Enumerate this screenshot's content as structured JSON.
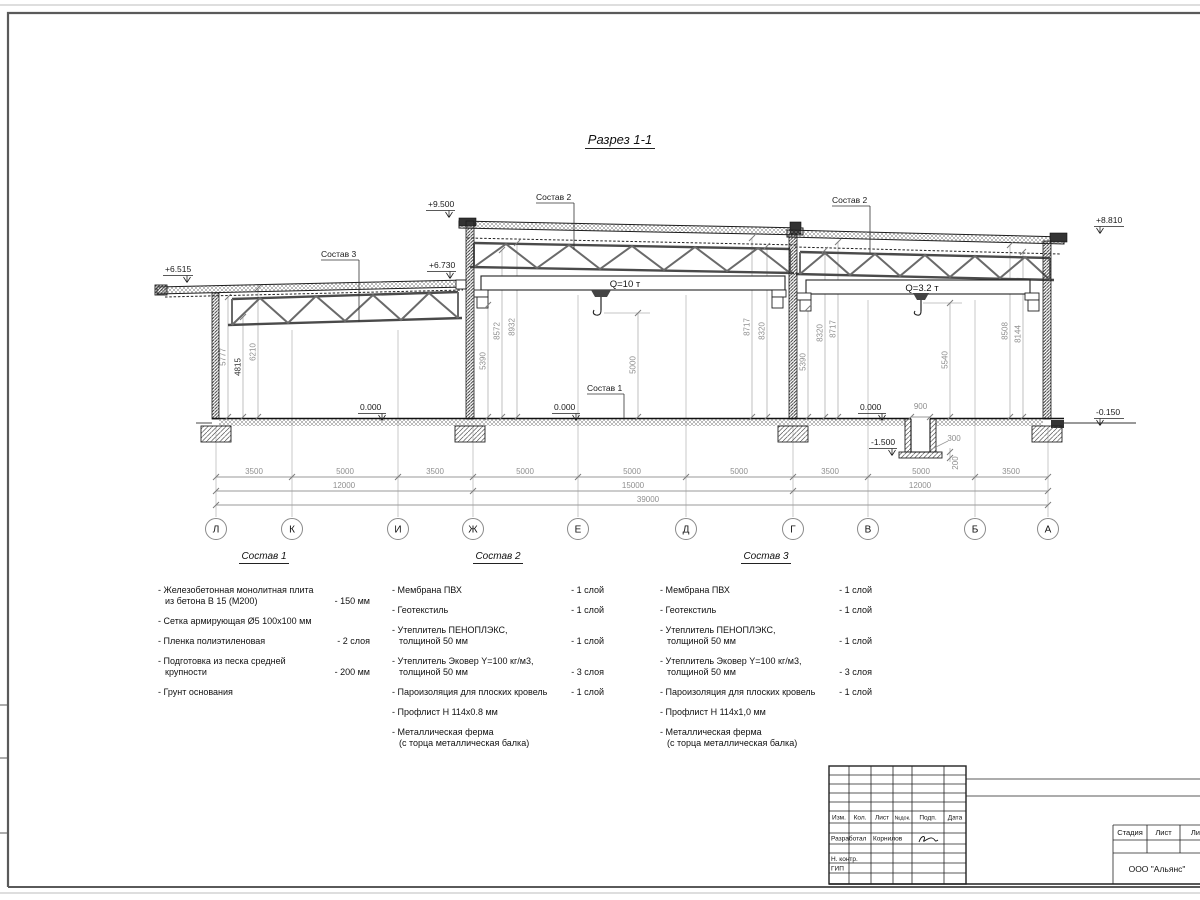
{
  "page": {
    "sheet_title": "Разрез 1-1"
  },
  "drawing": {
    "elevations": {
      "left_eave": "+6.515",
      "low_right": "+6.730",
      "mid_top": "+9.500",
      "right_top": "+8.810",
      "floor_left": "0.000",
      "floor_mid": "0.000",
      "floor_right": "0.000",
      "pit_bottom": "-1.500",
      "ground_right": "-0.150"
    },
    "callouts": {
      "sostav1": "Состав 1",
      "sostav2_mid": "Состав 2",
      "sostav2_right": "Состав 2",
      "sostav3": "Состав 3"
    },
    "cranes": {
      "mid": "Q=10 т",
      "right": "Q=3.2 т"
    },
    "vdims": {
      "l1": "5777",
      "l2": "4815",
      "l3": "6210",
      "m1": "5390",
      "m2": "8572",
      "m3": "8932",
      "m4": "5000",
      "m5": "8717",
      "m6": "8320",
      "r1": "5390",
      "r2": "8320",
      "r3": "8717",
      "r4": "5540",
      "r5": "8508",
      "r6": "8144"
    },
    "pit": {
      "width": "900",
      "wall": "300",
      "slab": "200"
    },
    "dims": {
      "row1": [
        "3500",
        "5000",
        "3500",
        "5000",
        "5000",
        "5000",
        "3500",
        "5000",
        "3500"
      ],
      "row2": [
        "12000",
        "15000",
        "12000"
      ],
      "total": "39000"
    },
    "grid": [
      "Л",
      "К",
      "И",
      "Ж",
      "Е",
      "Д",
      "Г",
      "В",
      "Б",
      "А"
    ]
  },
  "legends": [
    {
      "title": "Состав 1",
      "items": [
        {
          "name": "- Железобетонная  монолитная плита\nиз бетона В 15 (М200)",
          "value": "- 150 мм"
        },
        {
          "name": "- Сетка армирующая Ø5 100х100 мм",
          "value": ""
        },
        {
          "name": "- Пленка полиэтиленовая",
          "value": "-  2 слоя"
        },
        {
          "name": "- Подготовка из песка средней\nкрупности",
          "value": "- 200 мм"
        },
        {
          "name": "- Грунт основания",
          "value": ""
        }
      ]
    },
    {
      "title": "Состав 2",
      "items": [
        {
          "name": "- Мембрана ПВХ",
          "value": "- 1 слой"
        },
        {
          "name": "- Геотекстиль",
          "value": "- 1 слой"
        },
        {
          "name": "- Утеплитель ПЕНОПЛЭКС,\nтолщиной 50 мм",
          "value": "- 1 слой"
        },
        {
          "name": "- Утеплитель Эковер Y=100 кг/м3,\nтолщиной 50 мм",
          "value": "- 3 слоя"
        },
        {
          "name": "- Пароизоляция для плоских кровель",
          "value": "- 1 слой"
        },
        {
          "name": "- Профлист Н 114х0.8 мм",
          "value": ""
        },
        {
          "name": "- Металлическая ферма\n(с торца металлическая балка)",
          "value": ""
        }
      ]
    },
    {
      "title": "Состав 3",
      "items": [
        {
          "name": "- Мембрана ПВХ",
          "value": "- 1 слой"
        },
        {
          "name": "- Геотекстиль",
          "value": "- 1 слой"
        },
        {
          "name": "- Утеплитель ПЕНОПЛЭКС,\nтолщиной 50 мм",
          "value": "- 1 слой"
        },
        {
          "name": "- Утеплитель Эковер Y=100 кг/м3,\nтолщиной 50 мм",
          "value": "- 3 слоя"
        },
        {
          "name": "- Пароизоляция для плоских кровель",
          "value": "- 1 слой"
        },
        {
          "name": "- Профлист Н 114х1,0 мм",
          "value": ""
        },
        {
          "name": "- Металлическая ферма\n(с торца металлическая балка)",
          "value": ""
        }
      ]
    }
  ],
  "titleblock": {
    "header": [
      "Изм.",
      "Кол.",
      "Лист",
      "№док.",
      "Подп.",
      "Дата"
    ],
    "rows": [
      {
        "label": "Разработал",
        "value": "Корнилов"
      },
      {
        "label": "Н. контр.",
        "value": ""
      },
      {
        "label": "ГИП",
        "value": ""
      }
    ],
    "stage": [
      "Стадия",
      "Лист",
      "Листов"
    ],
    "company": "ООО \"Альянс\""
  }
}
